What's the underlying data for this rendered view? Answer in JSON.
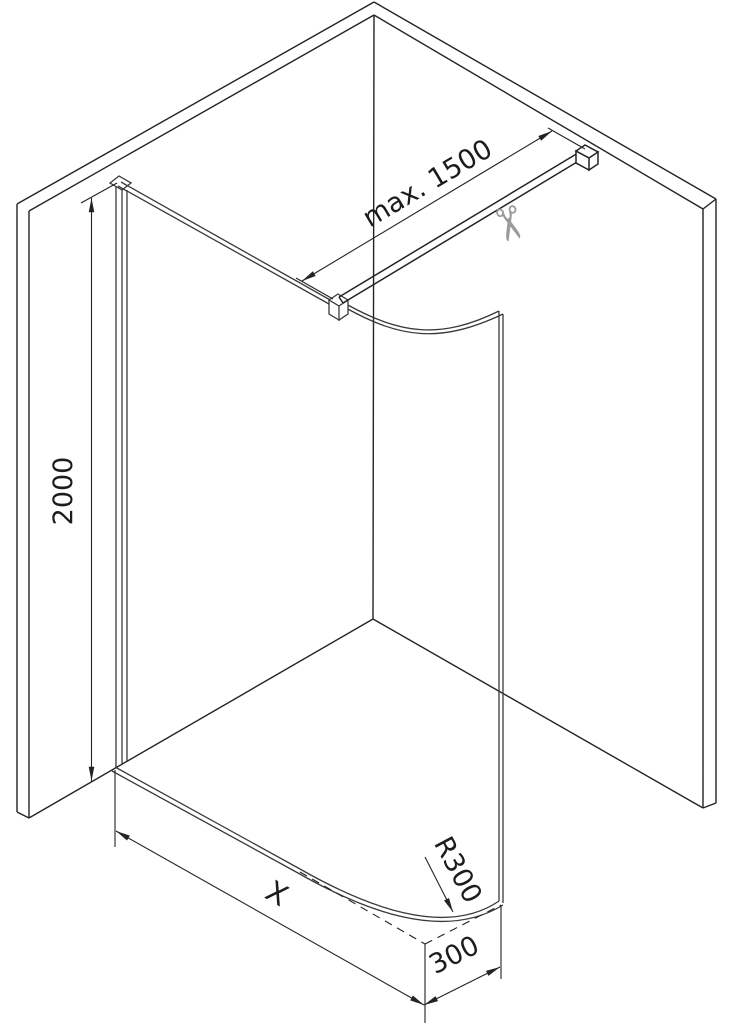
{
  "diagram": {
    "labels": {
      "bar_max_length": "max. 1500",
      "glass_height": "2000",
      "glass_width": "X",
      "corner_radius": "R300",
      "corner_depth": "300"
    },
    "icons": {
      "scissors_glyph": "✂"
    },
    "colors": {
      "wall_line": "#232323",
      "glass_line": "#3a3a3a",
      "bar_line": "#232323",
      "dimension_line": "#232323",
      "label_text": "#1c1c1c",
      "scissors": "#9b9b9b",
      "background": "#ffffff"
    }
  }
}
